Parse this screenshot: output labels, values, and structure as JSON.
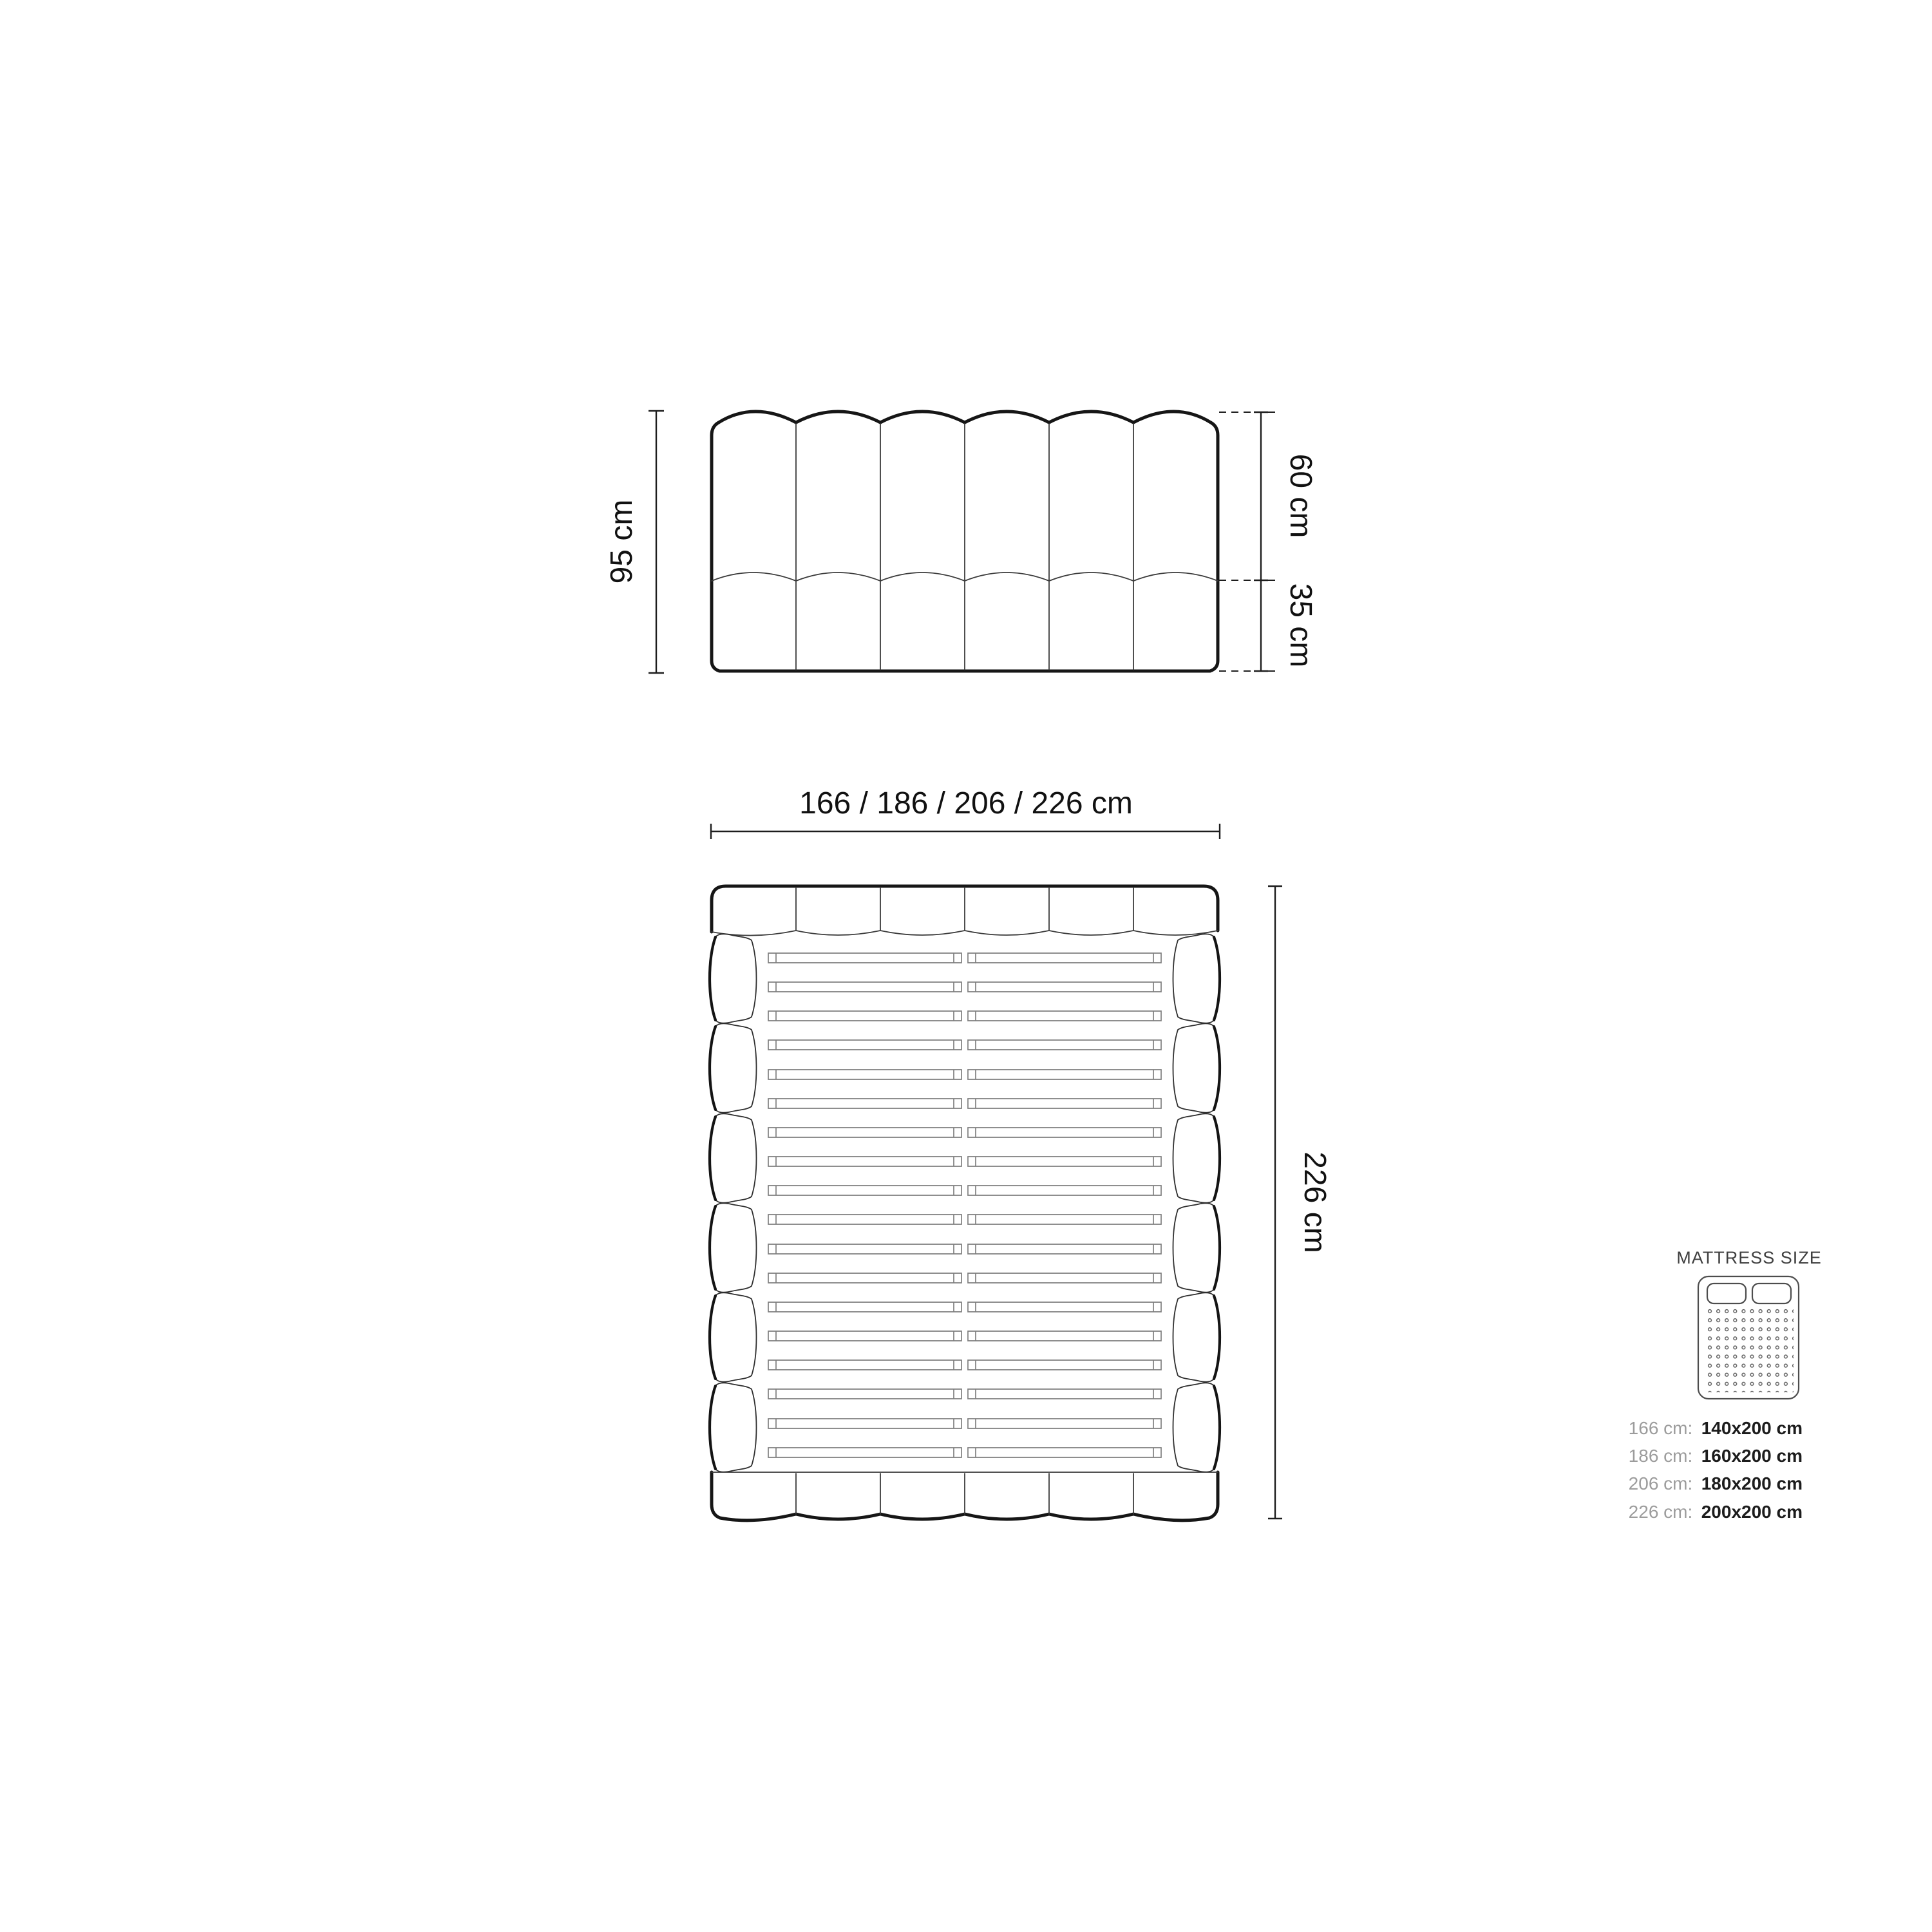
{
  "diagram": {
    "front_view": {
      "total_height": "95 cm",
      "upper_height": "60 cm",
      "lower_height": "35 cm"
    },
    "top_view": {
      "width_options": "166 / 186 / 206 / 226 cm",
      "length": "226 cm"
    },
    "legend": {
      "title": "MATTRESS SIZE",
      "rows": [
        {
          "frame": "166 cm:",
          "mattress": "140x200 cm"
        },
        {
          "frame": "186 cm:",
          "mattress": "160x200 cm"
        },
        {
          "frame": "206 cm:",
          "mattress": "180x200 cm"
        },
        {
          "frame": "226 cm:",
          "mattress": "200x200 cm"
        }
      ]
    },
    "colors": {
      "background": "#ffffff",
      "outline": "#161616",
      "thin_line": "#3a3a3a",
      "slat_line": "#7f7f7f",
      "legend_line": "#4d4d4d",
      "muted_text": "#9c9c9c",
      "text": "#111111"
    }
  }
}
